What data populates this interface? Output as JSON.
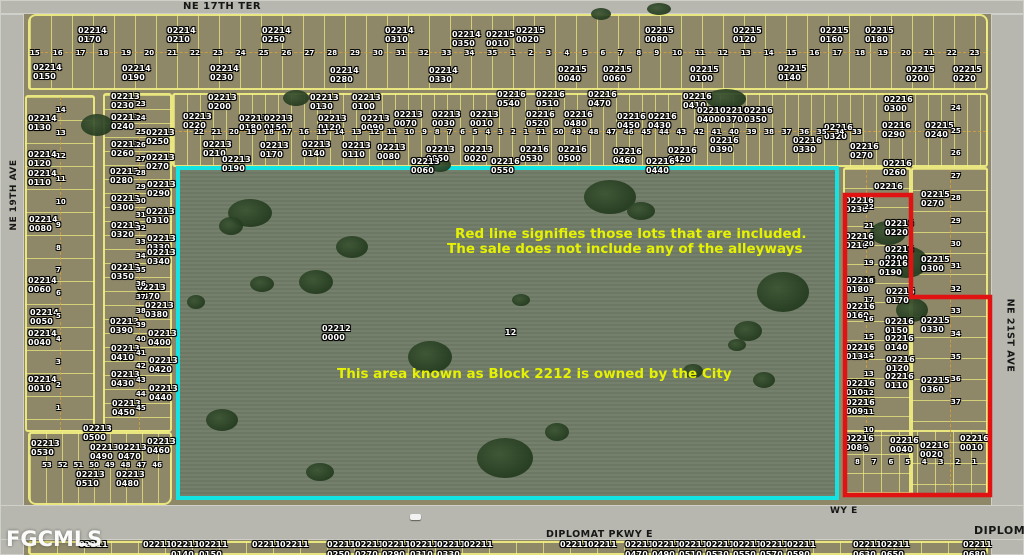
{
  "map": {
    "streets": {
      "top": "NE 17TH TER",
      "left": "NE 19TH AVE",
      "right": "NE 21ST AVE",
      "bottom": "DIPLOMAT PKWY E",
      "bottom_mid_partial": "WY E",
      "bottom_right_partial": "DIPLOM"
    },
    "watermark": "FGCMLS",
    "annotations": {
      "red_line_note_1": "Red line signifies those lots that are included.",
      "red_line_note_2": "The sale does not include any of the alleyways",
      "block_note": "This area known as Block 2212 is owned by the City"
    },
    "colors": {
      "cyan_boundary": "#14e3e3",
      "red_boundary": "#e01212",
      "lot_line_yellow": "#f3f082",
      "annotation_yellow": "#e6f202",
      "land": "#8e8869",
      "field": "#6f7c67",
      "road": "#b7b7af",
      "parcel_label_white": "#ffffff"
    },
    "parcel_labels": [
      {
        "x": 78,
        "y": 26,
        "t": "02214\n0170"
      },
      {
        "x": 167,
        "y": 26,
        "t": "02214\n0210"
      },
      {
        "x": 262,
        "y": 26,
        "t": "02214\n0250"
      },
      {
        "x": 385,
        "y": 26,
        "t": "02214\n0310"
      },
      {
        "x": 452,
        "y": 30,
        "t": "02214\n0350"
      },
      {
        "x": 486,
        "y": 30,
        "t": "02215\n0010"
      },
      {
        "x": 516,
        "y": 26,
        "t": "02215\n0020"
      },
      {
        "x": 645,
        "y": 26,
        "t": "02215\n0080"
      },
      {
        "x": 733,
        "y": 26,
        "t": "02215\n0120"
      },
      {
        "x": 820,
        "y": 26,
        "t": "02215\n0160"
      },
      {
        "x": 865,
        "y": 26,
        "t": "02215\n0180"
      },
      {
        "x": 33,
        "y": 63,
        "t": "02214\n0150"
      },
      {
        "x": 122,
        "y": 64,
        "t": "02214\n0190"
      },
      {
        "x": 210,
        "y": 64,
        "t": "02214\n0230"
      },
      {
        "x": 330,
        "y": 66,
        "t": "02214\n0280"
      },
      {
        "x": 429,
        "y": 66,
        "t": "02214\n0330"
      },
      {
        "x": 558,
        "y": 65,
        "t": "02215\n0040"
      },
      {
        "x": 603,
        "y": 65,
        "t": "02215\n0060"
      },
      {
        "x": 690,
        "y": 65,
        "t": "02215\n0100"
      },
      {
        "x": 778,
        "y": 64,
        "t": "02215\n0140"
      },
      {
        "x": 906,
        "y": 65,
        "t": "02215\n0200"
      },
      {
        "x": 953,
        "y": 65,
        "t": "02215\n0220"
      },
      {
        "x": 111,
        "y": 92,
        "t": "02213\n0230"
      },
      {
        "x": 208,
        "y": 93,
        "t": "02213\n0200"
      },
      {
        "x": 310,
        "y": 93,
        "t": "02213\n0130"
      },
      {
        "x": 352,
        "y": 93,
        "t": "02213\n0100"
      },
      {
        "x": 497,
        "y": 90,
        "t": "02216\n0540"
      },
      {
        "x": 536,
        "y": 90,
        "t": "02216\n0510"
      },
      {
        "x": 588,
        "y": 90,
        "t": "02216\n0470"
      },
      {
        "x": 683,
        "y": 92,
        "t": "02216\n0410"
      },
      {
        "x": 884,
        "y": 95,
        "t": "02216\n0300"
      },
      {
        "x": 111,
        "y": 113,
        "t": "02213\n0240"
      },
      {
        "x": 183,
        "y": 112,
        "t": "02213\n0220"
      },
      {
        "x": 239,
        "y": 114,
        "t": "02213\n0180"
      },
      {
        "x": 264,
        "y": 114,
        "t": "02213\n0150"
      },
      {
        "x": 318,
        "y": 114,
        "t": "02213\n0120"
      },
      {
        "x": 361,
        "y": 114,
        "t": "02213\n0090"
      },
      {
        "x": 394,
        "y": 110,
        "t": "02213\n0070"
      },
      {
        "x": 432,
        "y": 110,
        "t": "02213\n0030"
      },
      {
        "x": 470,
        "y": 110,
        "t": "02213\n0010"
      },
      {
        "x": 526,
        "y": 110,
        "t": "02216\n0520"
      },
      {
        "x": 564,
        "y": 110,
        "t": "02216\n0480"
      },
      {
        "x": 617,
        "y": 112,
        "t": "02216\n0450"
      },
      {
        "x": 648,
        "y": 112,
        "t": "02216\n0430"
      },
      {
        "x": 697,
        "y": 106,
        "t": "02216\n0400"
      },
      {
        "x": 720,
        "y": 106,
        "t": "02216\n0370"
      },
      {
        "x": 744,
        "y": 106,
        "t": "02216\n0350"
      },
      {
        "x": 824,
        "y": 123,
        "t": "02216\n0320"
      },
      {
        "x": 882,
        "y": 121,
        "t": "02216\n0290"
      },
      {
        "x": 925,
        "y": 121,
        "t": "02215\n0240"
      },
      {
        "x": 146,
        "y": 128,
        "t": "02213\n0250"
      },
      {
        "x": 111,
        "y": 140,
        "t": "02213\n0260"
      },
      {
        "x": 203,
        "y": 140,
        "t": "02213\n0210"
      },
      {
        "x": 260,
        "y": 141,
        "t": "02213\n0170"
      },
      {
        "x": 302,
        "y": 140,
        "t": "02213\n0140"
      },
      {
        "x": 342,
        "y": 141,
        "t": "02213\n0110"
      },
      {
        "x": 377,
        "y": 143,
        "t": "02213\n0080"
      },
      {
        "x": 146,
        "y": 153,
        "t": "02213\n0270"
      },
      {
        "x": 426,
        "y": 145,
        "t": "02213\n0050"
      },
      {
        "x": 464,
        "y": 145,
        "t": "02213\n0020"
      },
      {
        "x": 520,
        "y": 145,
        "t": "02216\n0530"
      },
      {
        "x": 558,
        "y": 145,
        "t": "02216\n0500"
      },
      {
        "x": 613,
        "y": 147,
        "t": "02216\n0460"
      },
      {
        "x": 668,
        "y": 146,
        "t": "02216\n0420"
      },
      {
        "x": 710,
        "y": 136,
        "t": "02216\n0390"
      },
      {
        "x": 793,
        "y": 136,
        "t": "02216\n0330"
      },
      {
        "x": 850,
        "y": 142,
        "t": "02216\n0270"
      },
      {
        "x": 222,
        "y": 155,
        "t": "02213\n0190"
      },
      {
        "x": 411,
        "y": 157,
        "t": "02213\n0060"
      },
      {
        "x": 491,
        "y": 157,
        "t": "02216\n0550"
      },
      {
        "x": 646,
        "y": 157,
        "t": "02216\n0440"
      },
      {
        "x": 883,
        "y": 159,
        "t": "02216\n0260"
      },
      {
        "x": 874,
        "y": 182,
        "t": "02216"
      },
      {
        "x": 845,
        "y": 196,
        "t": "02216\n0230"
      },
      {
        "x": 885,
        "y": 219,
        "t": "02216\n0220"
      },
      {
        "x": 845,
        "y": 232,
        "t": "02216\n0210"
      },
      {
        "x": 885,
        "y": 245,
        "t": "02216\n0200"
      },
      {
        "x": 879,
        "y": 259,
        "t": "02216\n0190"
      },
      {
        "x": 846,
        "y": 276,
        "t": "02216\n0180"
      },
      {
        "x": 886,
        "y": 287,
        "t": "02216\n0170"
      },
      {
        "x": 846,
        "y": 302,
        "t": "02216\n0160"
      },
      {
        "x": 885,
        "y": 317,
        "t": "02216\n0150"
      },
      {
        "x": 885,
        "y": 334,
        "t": "02216\n0140"
      },
      {
        "x": 846,
        "y": 343,
        "t": "02216\n0130"
      },
      {
        "x": 886,
        "y": 355,
        "t": "02216\n0120"
      },
      {
        "x": 885,
        "y": 372,
        "t": "02216\n0110"
      },
      {
        "x": 846,
        "y": 379,
        "t": "02216\n0100"
      },
      {
        "x": 846,
        "y": 398,
        "t": "02216\n0090"
      },
      {
        "x": 921,
        "y": 190,
        "t": "02215\n0270"
      },
      {
        "x": 921,
        "y": 255,
        "t": "02215\n0300"
      },
      {
        "x": 921,
        "y": 316,
        "t": "02215\n0330"
      },
      {
        "x": 921,
        "y": 376,
        "t": "02215\n0360"
      },
      {
        "x": 845,
        "y": 434,
        "t": "02216\n0080"
      },
      {
        "x": 890,
        "y": 436,
        "t": "02216\n0040"
      },
      {
        "x": 920,
        "y": 441,
        "t": "02216\n0020"
      },
      {
        "x": 960,
        "y": 434,
        "t": "02216\n0010"
      },
      {
        "x": 28,
        "y": 114,
        "t": "02214\n0130"
      },
      {
        "x": 28,
        "y": 150,
        "t": "02214\n0120"
      },
      {
        "x": 28,
        "y": 169,
        "t": "02214\n0110"
      },
      {
        "x": 29,
        "y": 215,
        "t": "02214\n0080"
      },
      {
        "x": 28,
        "y": 276,
        "t": "02214\n0060"
      },
      {
        "x": 30,
        "y": 308,
        "t": "02214\n0050"
      },
      {
        "x": 28,
        "y": 329,
        "t": "02214\n0040"
      },
      {
        "x": 28,
        "y": 375,
        "t": "02214\n0010"
      },
      {
        "x": 110,
        "y": 167,
        "t": "02213\n0280"
      },
      {
        "x": 147,
        "y": 180,
        "t": "02213\n0290"
      },
      {
        "x": 111,
        "y": 194,
        "t": "02213\n0300"
      },
      {
        "x": 146,
        "y": 207,
        "t": "02213\n0310"
      },
      {
        "x": 111,
        "y": 221,
        "t": "02213\n0320"
      },
      {
        "x": 147,
        "y": 234,
        "t": "02213\n0330"
      },
      {
        "x": 147,
        "y": 248,
        "t": "02213\n0340"
      },
      {
        "x": 111,
        "y": 263,
        "t": "02213\n0350"
      },
      {
        "x": 137,
        "y": 283,
        "t": "02213\n0370"
      },
      {
        "x": 145,
        "y": 301,
        "t": "02213\n0380"
      },
      {
        "x": 110,
        "y": 317,
        "t": "02213\n0390"
      },
      {
        "x": 148,
        "y": 329,
        "t": "02213\n0400"
      },
      {
        "x": 111,
        "y": 344,
        "t": "02213\n0410"
      },
      {
        "x": 149,
        "y": 356,
        "t": "02213\n0420"
      },
      {
        "x": 111,
        "y": 370,
        "t": "02213\n0430"
      },
      {
        "x": 149,
        "y": 384,
        "t": "02213\n0440"
      },
      {
        "x": 112,
        "y": 399,
        "t": "02213\n0450"
      },
      {
        "x": 31,
        "y": 439,
        "t": "02213\n0530"
      },
      {
        "x": 83,
        "y": 424,
        "t": "02213\n0500"
      },
      {
        "x": 90,
        "y": 443,
        "t": "02213\n0490"
      },
      {
        "x": 118,
        "y": 443,
        "t": "02213\n0470"
      },
      {
        "x": 147,
        "y": 437,
        "t": "02213\n0460"
      },
      {
        "x": 76,
        "y": 470,
        "t": "02213\n0510"
      },
      {
        "x": 116,
        "y": 470,
        "t": "02213\n0480"
      },
      {
        "x": 322,
        "y": 324,
        "t": "02212\n0000"
      },
      {
        "x": 505,
        "y": 328,
        "t": "12"
      }
    ],
    "lot_strips": [
      {
        "x": 30,
        "y": 49,
        "w": 950,
        "h": 9,
        "dir": "h",
        "nums": [
          15,
          16,
          17,
          18,
          19,
          20,
          21,
          22,
          23,
          24,
          25,
          26,
          27,
          28,
          29,
          30,
          31,
          32,
          33,
          34,
          35,
          1,
          2,
          3,
          4,
          5,
          6,
          7,
          8,
          9,
          10,
          11,
          12,
          13,
          14,
          15,
          16,
          17,
          18,
          19,
          20,
          21,
          22,
          23
        ]
      },
      {
        "x": 194,
        "y": 128,
        "w": 668,
        "h": 9,
        "dir": "h",
        "nums": [
          22,
          21,
          20,
          19,
          18,
          17,
          16,
          15,
          14,
          13,
          12,
          11,
          10,
          9,
          8,
          7,
          6,
          5,
          4,
          3,
          2,
          1,
          51,
          50,
          49,
          48,
          47,
          46,
          45,
          44,
          43,
          42,
          41,
          40,
          39,
          38,
          37,
          36,
          35,
          34,
          33
        ]
      },
      {
        "x": 56,
        "y": 106,
        "w": 10,
        "h": 306,
        "dir": "v",
        "nums": [
          14,
          13,
          12,
          11,
          10,
          9,
          8,
          7,
          6,
          5,
          4,
          3,
          2,
          1
        ]
      },
      {
        "x": 136,
        "y": 100,
        "w": 10,
        "h": 312,
        "dir": "v",
        "nums": [
          23,
          24,
          25,
          26,
          27,
          28,
          29,
          30,
          31,
          32,
          33,
          34,
          35,
          36,
          37,
          38,
          39,
          40,
          41,
          42,
          43,
          44,
          45
        ]
      },
      {
        "x": 864,
        "y": 203,
        "w": 10,
        "h": 250,
        "dir": "v",
        "nums": [
          22,
          21,
          20,
          19,
          18,
          17,
          16,
          15,
          14,
          13,
          12,
          11,
          10,
          9
        ]
      },
      {
        "x": 951,
        "y": 104,
        "w": 10,
        "h": 302,
        "dir": "v",
        "nums": [
          24,
          25,
          26,
          27,
          28,
          29,
          30,
          31,
          32,
          33,
          34,
          35,
          36,
          37
        ]
      },
      {
        "x": 855,
        "y": 458,
        "w": 122,
        "h": 9,
        "dir": "h",
        "nums": [
          8,
          7,
          6,
          5,
          4,
          3,
          2,
          1
        ]
      },
      {
        "x": 42,
        "y": 461,
        "w": 120,
        "h": 9,
        "dir": "h",
        "nums": [
          53,
          52,
          51,
          50,
          49,
          48,
          47,
          46
        ]
      }
    ],
    "bottom_row": {
      "text": "02211",
      "y": 540,
      "label_xs": [
        79,
        143,
        171,
        199,
        252,
        280,
        327,
        355,
        382,
        410,
        437,
        464,
        560,
        588,
        625,
        652,
        679,
        706,
        733,
        760,
        787,
        853,
        881,
        963
      ],
      "partial_y": 550,
      "partials": [
        {
          "x": 171,
          "t": "0140"
        },
        {
          "x": 199,
          "t": "0150"
        },
        {
          "x": 327,
          "t": "0250"
        },
        {
          "x": 355,
          "t": "0270"
        },
        {
          "x": 382,
          "t": "0290"
        },
        {
          "x": 410,
          "t": "0310"
        },
        {
          "x": 437,
          "t": "0330"
        },
        {
          "x": 625,
          "t": "0470"
        },
        {
          "x": 652,
          "t": "0490"
        },
        {
          "x": 679,
          "t": "0510"
        },
        {
          "x": 706,
          "t": "0530"
        },
        {
          "x": 733,
          "t": "0550"
        },
        {
          "x": 760,
          "t": "0570"
        },
        {
          "x": 787,
          "t": "0590"
        },
        {
          "x": 853,
          "t": "0630"
        },
        {
          "x": 881,
          "t": "0650"
        },
        {
          "x": 963,
          "t": "0680"
        }
      ]
    },
    "red_boundary_points": "845,195 911,195 911,297 990,297 990,495 845,495",
    "trees": [
      {
        "x": 250,
        "y": 213,
        "w": 44,
        "h": 28
      },
      {
        "x": 231,
        "y": 226,
        "w": 24,
        "h": 18
      },
      {
        "x": 352,
        "y": 247,
        "w": 32,
        "h": 22
      },
      {
        "x": 316,
        "y": 282,
        "w": 34,
        "h": 24
      },
      {
        "x": 262,
        "y": 284,
        "w": 24,
        "h": 16
      },
      {
        "x": 430,
        "y": 357,
        "w": 44,
        "h": 32
      },
      {
        "x": 610,
        "y": 197,
        "w": 52,
        "h": 34
      },
      {
        "x": 641,
        "y": 211,
        "w": 28,
        "h": 18
      },
      {
        "x": 783,
        "y": 292,
        "w": 52,
        "h": 40
      },
      {
        "x": 748,
        "y": 331,
        "w": 28,
        "h": 20
      },
      {
        "x": 505,
        "y": 458,
        "w": 56,
        "h": 40
      },
      {
        "x": 557,
        "y": 432,
        "w": 24,
        "h": 18
      },
      {
        "x": 693,
        "y": 371,
        "w": 20,
        "h": 14
      },
      {
        "x": 764,
        "y": 380,
        "w": 22,
        "h": 16
      },
      {
        "x": 222,
        "y": 420,
        "w": 32,
        "h": 22
      },
      {
        "x": 196,
        "y": 302,
        "w": 18,
        "h": 14
      },
      {
        "x": 521,
        "y": 300,
        "w": 18,
        "h": 12
      },
      {
        "x": 737,
        "y": 345,
        "w": 18,
        "h": 12
      },
      {
        "x": 97,
        "y": 125,
        "w": 32,
        "h": 22
      },
      {
        "x": 296,
        "y": 98,
        "w": 26,
        "h": 16
      },
      {
        "x": 726,
        "y": 99,
        "w": 40,
        "h": 20
      },
      {
        "x": 888,
        "y": 233,
        "w": 36,
        "h": 24
      },
      {
        "x": 906,
        "y": 262,
        "w": 44,
        "h": 32
      },
      {
        "x": 912,
        "y": 310,
        "w": 32,
        "h": 24
      },
      {
        "x": 320,
        "y": 472,
        "w": 28,
        "h": 18
      },
      {
        "x": 601,
        "y": 14,
        "w": 20,
        "h": 12
      },
      {
        "x": 659,
        "y": 9,
        "w": 24,
        "h": 12
      },
      {
        "x": 440,
        "y": 165,
        "w": 22,
        "h": 14
      }
    ]
  }
}
